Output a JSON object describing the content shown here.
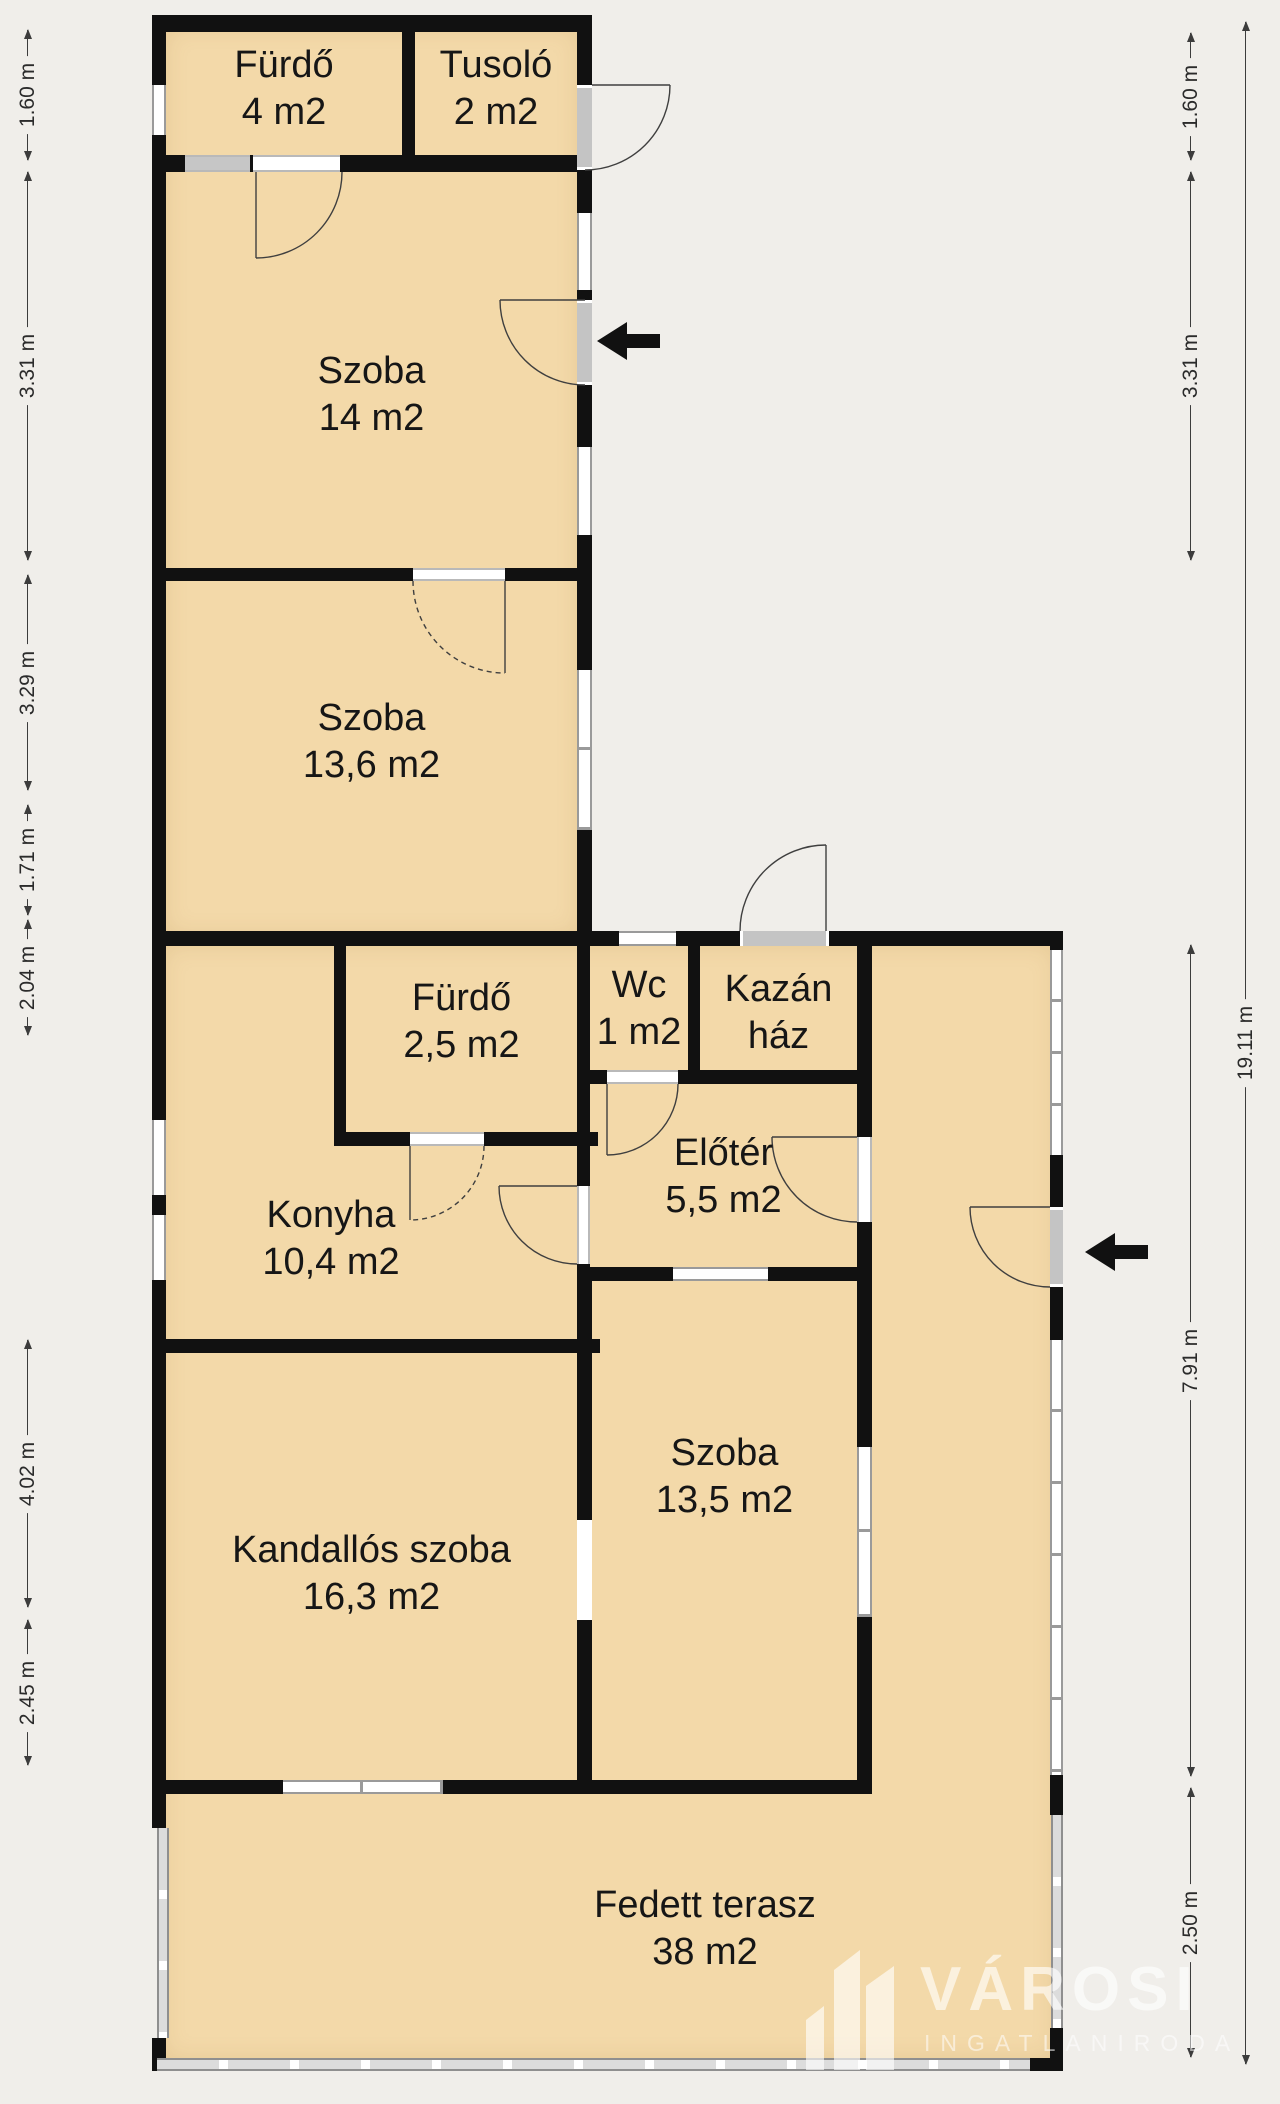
{
  "plan": {
    "type": "residential-floor-plan",
    "language": "hu",
    "rooms": [
      {
        "id": "furdo-4",
        "line1": "Fürdő",
        "line2": "4 m2"
      },
      {
        "id": "tusolo",
        "line1": "Tusoló",
        "line2": "2 m2"
      },
      {
        "id": "szoba-14",
        "line1": "Szoba",
        "line2": "14 m2"
      },
      {
        "id": "szoba-13-6",
        "line1": "Szoba",
        "line2": "13,6 m2"
      },
      {
        "id": "furdo-2-5",
        "line1": "Fürdő",
        "line2": "2,5 m2"
      },
      {
        "id": "wc",
        "line1": "Wc",
        "line2": "1 m2"
      },
      {
        "id": "kazan-haz",
        "line1": "Kazán",
        "line2": "ház"
      },
      {
        "id": "eloter",
        "line1": "Előtér",
        "line2": "5,5 m2"
      },
      {
        "id": "konyha",
        "line1": "Konyha",
        "line2": "10,4 m2"
      },
      {
        "id": "kandallos-szoba",
        "line1": "Kandallós szoba",
        "line2": "16,3 m2"
      },
      {
        "id": "szoba-13-5",
        "line1": "Szoba",
        "line2": "13,5 m2"
      },
      {
        "id": "fedett-terasz",
        "line1": "Fedett terasz",
        "line2": "38 m2"
      }
    ],
    "dimensions": {
      "left": [
        "1.60 m",
        "3.31 m",
        "3.29 m",
        "1.71 m",
        "2.04 m",
        "4.02 m",
        "2.45 m"
      ],
      "right_inner": [
        "1.60 m",
        "3.31 m",
        "7.91 m",
        "2.50 m"
      ],
      "right_outer": [
        "19.11 m"
      ]
    },
    "watermark": {
      "brand": "VÁROSI",
      "subtitle": "INGATLANIRODA"
    },
    "colors": {
      "background": "#f0eeea",
      "room_fill": "#f3d9a9",
      "wall": "#111111",
      "window_frame": "#9a9a9a",
      "exterior_door": "#c4c4c4",
      "door_swing": "#3f3f3f",
      "entrance_arrow": "#111111",
      "watermark_text": "rgba(255,255,255,0.6)"
    }
  }
}
